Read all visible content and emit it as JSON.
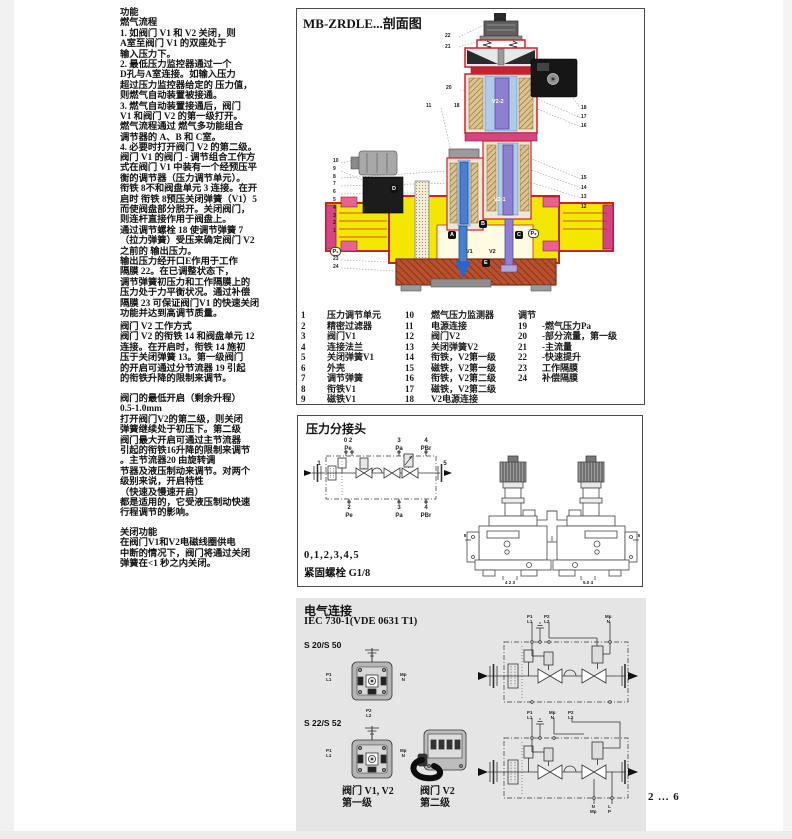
{
  "colors": {
    "body_yellow": "#f3e600",
    "casing_red": "#c8232c",
    "magenta": "#d64580",
    "v1_blue": "#4a7fd0",
    "v2_purple": "#8f7fd0",
    "coil_tan": "#d8c391",
    "panel_gray": "#e5e5e5"
  },
  "left_column": {
    "p1": "功能\n燃气流程\n1. 如阀门 V1 和 V2 关闭，则\nA室至阀门 V1 的双座处于\n输入压力下。\n2. 最低压力监控器通过一个\nD孔与A室连接。如输入压力\n超过压力监控器给定的 压力值，\n则燃气自动装置被接通。\n3. 燃气自动装置接通后，阀门\nV1 和阀门 V2 的第一级打开。\n燃气流程通过 燃气多功能组合\n调节器的 A、B 和 C室。\n4. 必要时打开阀门 V2 的第二级。",
    "p2": "阀门 V1 的阀门 - 调节组合工作方\n式在阀门 V1 中装有一个经预压平\n衡的调节器（压力调节单元）。\n衔铁 8不和阀盘单元 3 连接。在开\n启时 衔铁 8预压关闭弹簧（V1）5\n而使阀盘部分脱开。关闭阀门，\n则连杆直接作用于阀盘上。\n通过调节螺栓 18 使调节弹簧 7\n（拉力弹簧）受压来确定阀门 V2\n之前的 输出压力。\n输出压力经开口E作用于工作\n隔膜 22。在已调整状态下，\n调节弹簧初压力和工作隔膜上的\n压力处于力平衡状况。通过补偿\n隔膜 23 可保证阀门V1 的快速关闭\n功能并达到高调节质量。",
    "p3": "阀门 V2 工作方式\n阀门 V2 的衔铁 14 和阀盘单元 12\n连接。在开启时，衔铁 14 施初\n压于关闭弹簧 13。第一级阀门\n的开启可通过分节流器 19 引起\n的衔铁升降的限制来调节。",
    "p4": "阀门的最低开启（剩余升程）\n0.5-1.0mm\n打开阀门V2的第二级，则关闭\n弹簧继续处于初压下。第二级\n阀门最大开启可通过主节流器\n引起的衔铁16升降的限制来调节\n。主节流器20 由旋转调\n节器及液压制动来调节。对两个\n级别来说，开启特性\n（快速及慢速开启）\n都是适用的，它受液压制动快速\n行程调节的影响。",
    "p5": "关闭功能\n在阀门V1和V2电磁线圈供电\n中断的情况下，阀门将通过关闭\n弹簧在<1 秒之内关闭。"
  },
  "cross": {
    "title": "MB-ZRDLE...剖面图",
    "callouts": {
      "tl": [
        "22",
        "21"
      ],
      "c20": "20",
      "c11": "11",
      "c18": "18",
      "lcol": [
        "10",
        "9",
        "8",
        "7",
        "6",
        "5",
        "4",
        "3",
        "2",
        "1"
      ],
      "lbot": [
        "23",
        "24"
      ],
      "rtop": [
        "18",
        "17",
        "16"
      ],
      "rmid": [
        "15",
        "14",
        "13",
        "12"
      ]
    },
    "labels": {
      "p1": "P₁",
      "d": "D",
      "a": "A",
      "b": "B",
      "c": "C",
      "p2": "P₂",
      "v1": "V1",
      "v2": "V2",
      "e": "E",
      "v22": "V2-2",
      "v21": "V2-1"
    },
    "parts1": [
      {
        "n": "1",
        "label": "压力调节单元"
      },
      {
        "n": "2",
        "label": "精密过滤器"
      },
      {
        "n": "3",
        "label": "阀门V1"
      },
      {
        "n": "4",
        "label": "连接法兰"
      },
      {
        "n": "5",
        "label": "关闭弹簧V1"
      },
      {
        "n": "6",
        "label": "外壳"
      },
      {
        "n": "7",
        "label": "调节弹簧"
      },
      {
        "n": "8",
        "label": "衔铁V1"
      },
      {
        "n": "9",
        "label": "磁铁V1"
      }
    ],
    "parts2": [
      {
        "n": "10",
        "label": "燃气压力监测器"
      },
      {
        "n": "11",
        "label": "电源连接"
      },
      {
        "n": "12",
        "label": "阀门V2"
      },
      {
        "n": "13",
        "label": "关闭弹簧V2"
      },
      {
        "n": "14",
        "label": "衔铁，V2第一级"
      },
      {
        "n": "15",
        "label": "磁铁，V2第一级"
      },
      {
        "n": "16",
        "label": "衔铁，V2第二级"
      },
      {
        "n": "17",
        "label": "磁铁，V2第二级"
      },
      {
        "n": "18",
        "label": "V2电源连接"
      }
    ],
    "parts3_header": "调节",
    "parts3": [
      {
        "n": "19",
        "label": "-燃气压力Pa"
      },
      {
        "n": "20",
        "label": "-部分流量，第一级"
      },
      {
        "n": "21",
        "label": "-主流量"
      },
      {
        "n": "22",
        "label": "-快速提升"
      },
      {
        "n": "23",
        "label": "工作隔膜"
      },
      {
        "n": "24",
        "label": "补偿隔膜"
      }
    ]
  },
  "taps": {
    "title": "压力分接头",
    "top": [
      {
        "n": "0 2",
        "p": "Pe"
      },
      {
        "n": "3",
        "p": "Pa"
      },
      {
        "n": "4",
        "p": "PBr"
      }
    ],
    "bottom": [
      {
        "n": "2",
        "p": "Pe"
      },
      {
        "n": "3",
        "p": "Pa"
      },
      {
        "n": "4",
        "p": "PBr"
      }
    ],
    "inlet": "1",
    "outlet": "5",
    "note1": "0,1,2,3,4,5",
    "note2": "紧固螺栓 G1/8",
    "draw": {
      "left_tick": "5",
      "right_tick": "5",
      "under_left": "4  2 3",
      "under_right": "5.0  4"
    }
  },
  "electrical": {
    "title": "电气连接",
    "standard": "IEC 730-1(VDE 0631 T1)",
    "model1": "S 20/S 50",
    "model2": "S 22/S 52",
    "conn": {
      "left": "P1\nL1",
      "right": "Mp\nN",
      "bottom": "P2\nL2"
    },
    "c1": {
      "t1": "P1\nL1",
      "t2": "P2\nL2",
      "t3": "Mp\nN"
    },
    "c2": {
      "t1": "P1\nL1",
      "t2": "Mp\nN",
      "t3": "P2\nL2",
      "b1": "N\nMp",
      "b2": "L\nP"
    },
    "cap1": "阀门 V1, V2\n第一级",
    "cap2": "阀门 V2\n第二级"
  },
  "page": {
    "num": "2 ... 6"
  }
}
